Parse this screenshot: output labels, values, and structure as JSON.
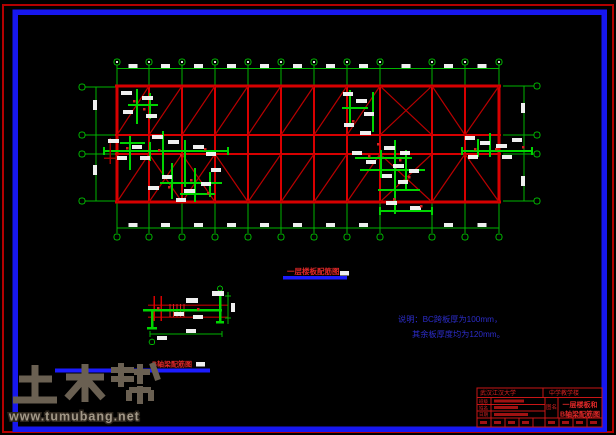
{
  "frame": {
    "outer_color": "#b40000",
    "inner_color": "#1717ef"
  },
  "plan": {
    "caption": "一层楼板配筋图"
  },
  "beam_detail": {
    "caption": "B轴梁配筋图"
  },
  "notes": {
    "line1": "说明：BC跨板厚为100mm，",
    "line2": "其余板厚度均为120mm。"
  },
  "title_block": {
    "school": "武汉江汉大学",
    "project": "中学教学楼",
    "name_label": "图名",
    "title_line1": "一层楼板和",
    "title_line2": "B轴梁配筋图",
    "rows": [
      {
        "label": "班级"
      },
      {
        "label": "姓名"
      },
      {
        "label": "日期"
      }
    ]
  },
  "watermark": {
    "brand": "土木帮",
    "url": "www.tumubang.net"
  },
  "colors": {
    "grid_red": "#d80000",
    "diagonal_red": "#b80000",
    "rebar_green": "#00d400",
    "dim_green": "#00b400",
    "label_white": "#efefef",
    "caption_red": "#e02828",
    "underline_blue": "#1c1cff",
    "note_blue": "#2c2cc8",
    "title_red": "#c81616"
  }
}
